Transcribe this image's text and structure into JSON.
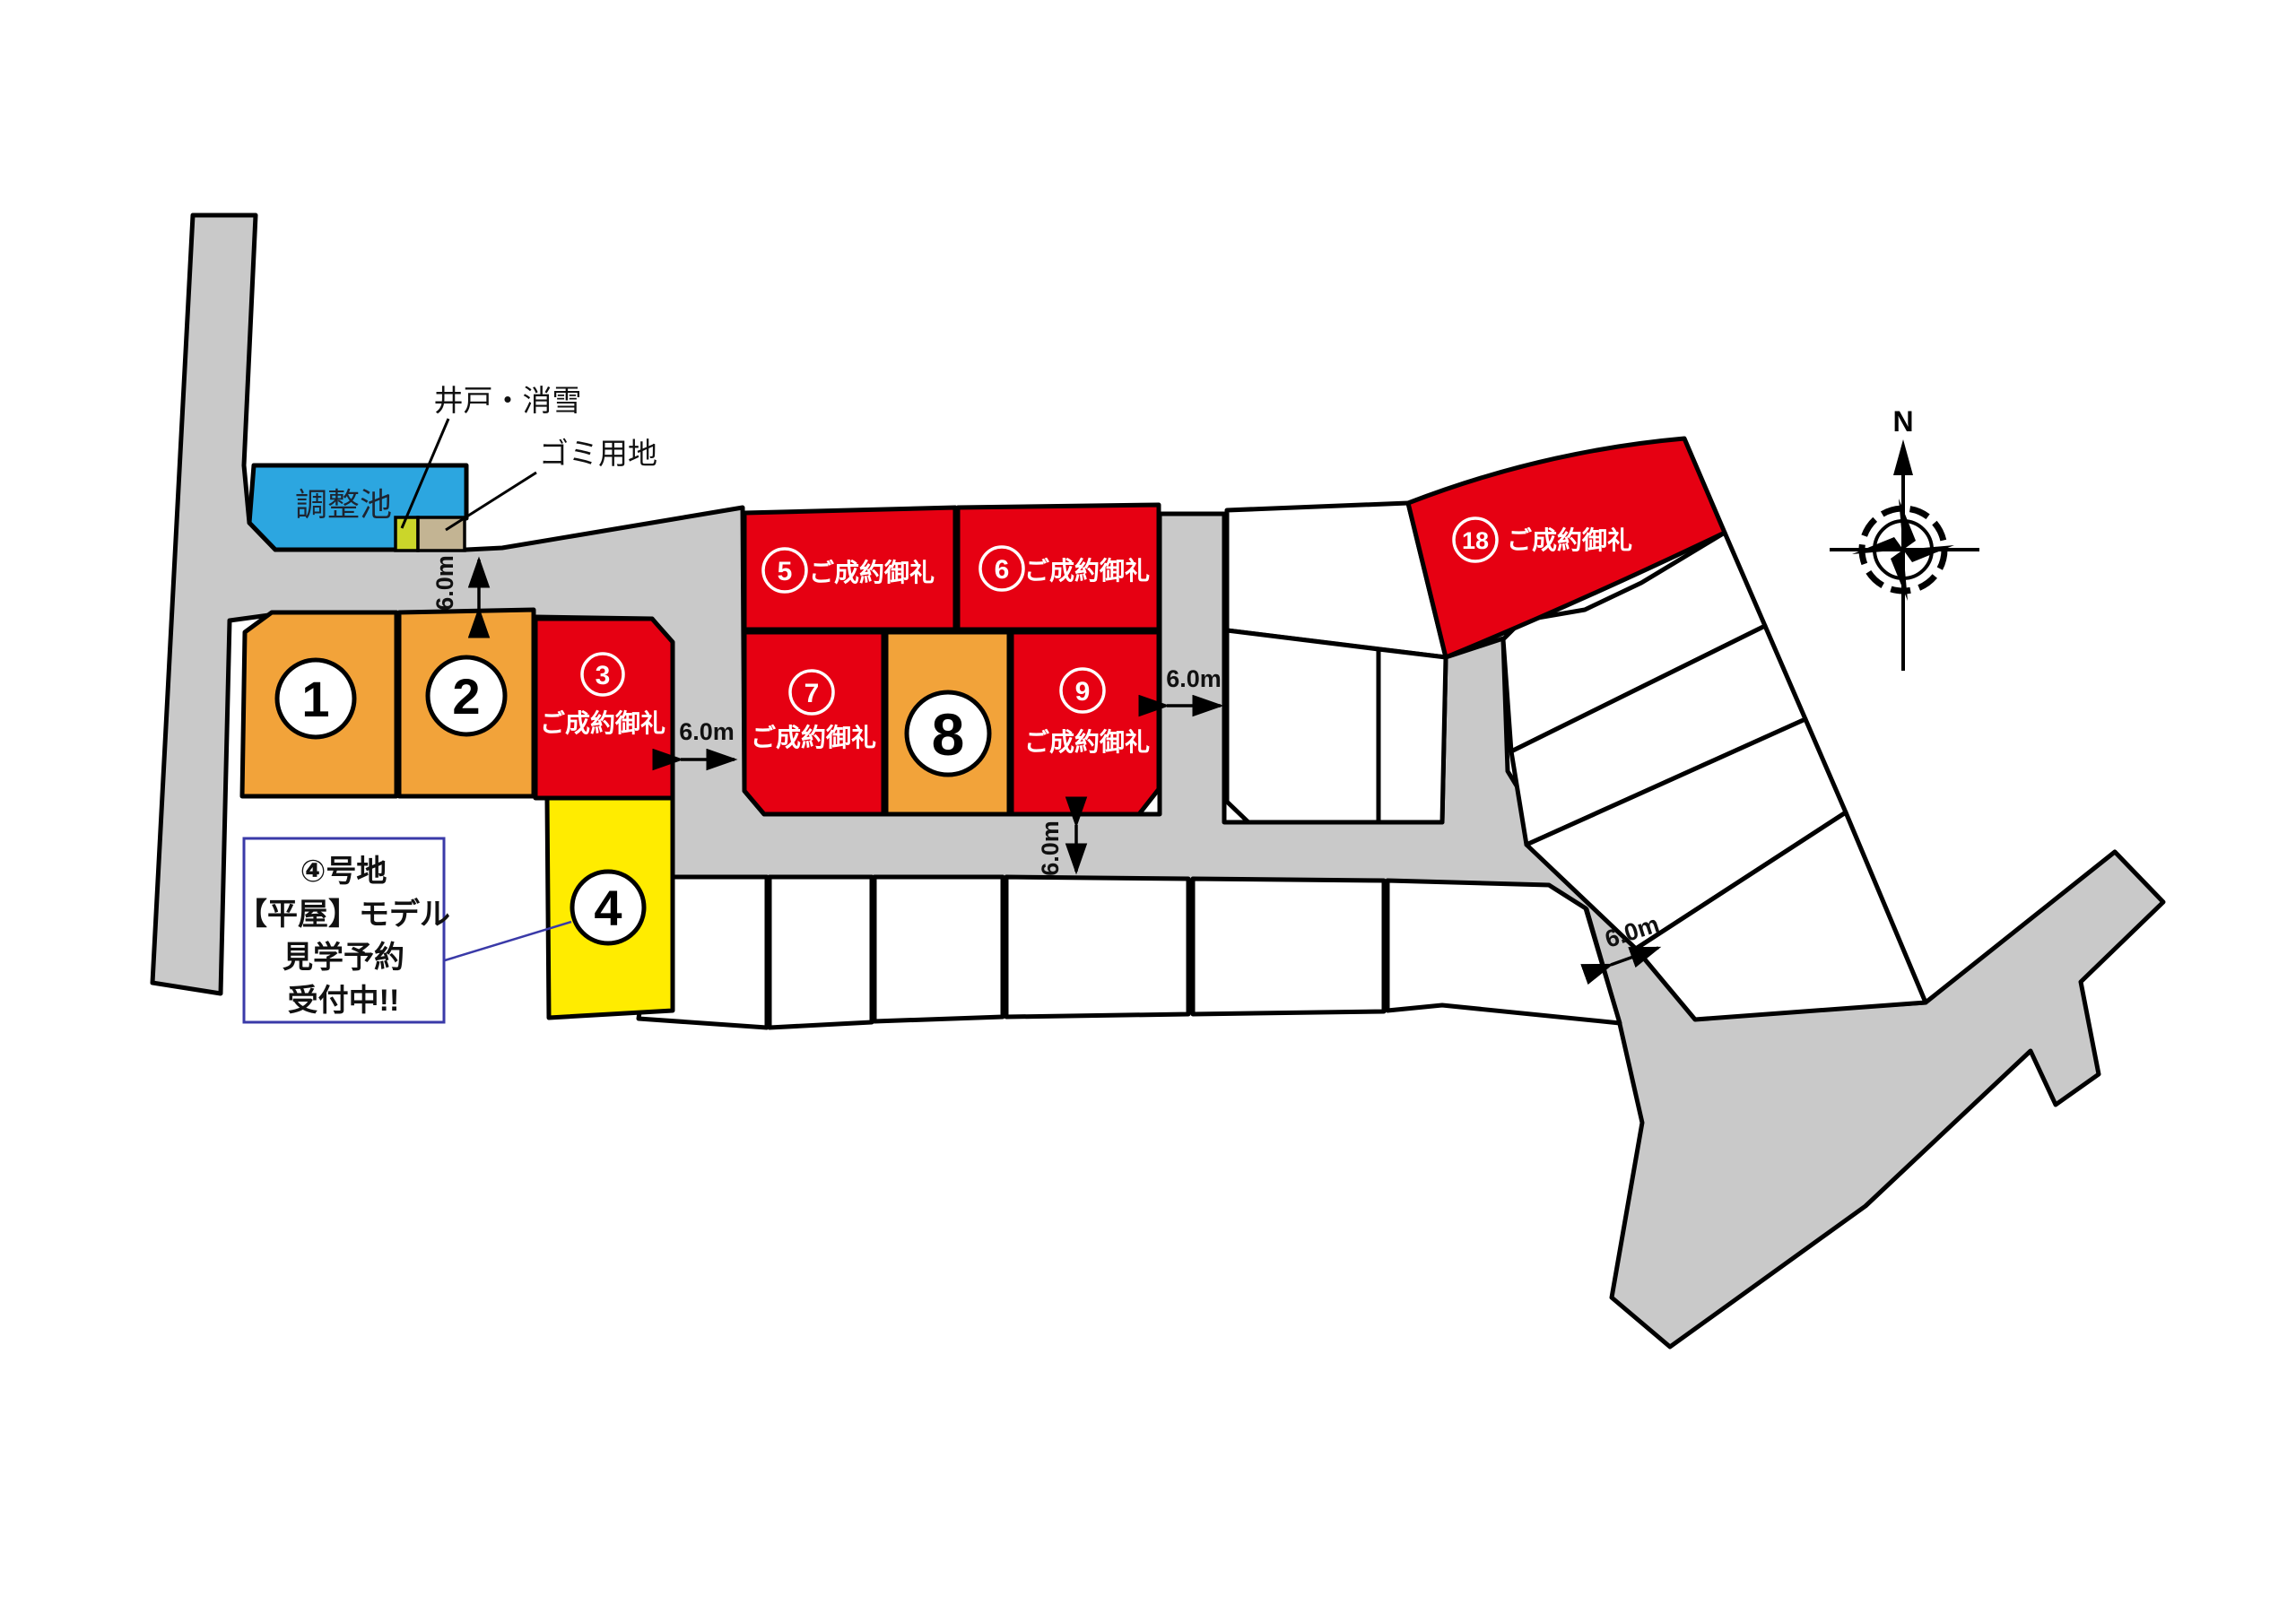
{
  "map": {
    "compass_label": "N",
    "pond_label": "調整池",
    "well_label": "井戸・消雪",
    "garbage_label": "ゴミ用地",
    "road_width_label": "6.0m",
    "annotation": {
      "line1": "④号地",
      "line2": "【平屋】モデル",
      "line3": "見学予約",
      "line4": "受付中!!"
    },
    "lots": [
      {
        "number": "1",
        "status": "",
        "color": "#f2a33a"
      },
      {
        "number": "2",
        "status": "",
        "color": "#f2a33a"
      },
      {
        "number": "3",
        "status": "ご成約御礼",
        "color": "#e60012"
      },
      {
        "number": "4",
        "status": "",
        "color": "#ffec00"
      },
      {
        "number": "5",
        "status": "ご成約御礼",
        "color": "#e60012"
      },
      {
        "number": "6",
        "status": "ご成約御礼",
        "color": "#e60012"
      },
      {
        "number": "7",
        "status": "ご成約御礼",
        "color": "#e60012"
      },
      {
        "number": "8",
        "status": "",
        "color": "#f2a33a"
      },
      {
        "number": "9",
        "status": "ご成約御礼",
        "color": "#e60012"
      },
      {
        "number": "18",
        "status": "ご成約御礼",
        "color": "#e60012"
      }
    ],
    "colors": {
      "sold_red": "#e60012",
      "available_orange": "#f2a33a",
      "model_yellow": "#ffec00",
      "pond_blue": "#2ca6e0",
      "road_gray": "#c9c9c9",
      "garbage_tan": "#c3b493",
      "well_yellow": "#cbd62a",
      "annotation_blue": "#3a3aa8"
    }
  }
}
